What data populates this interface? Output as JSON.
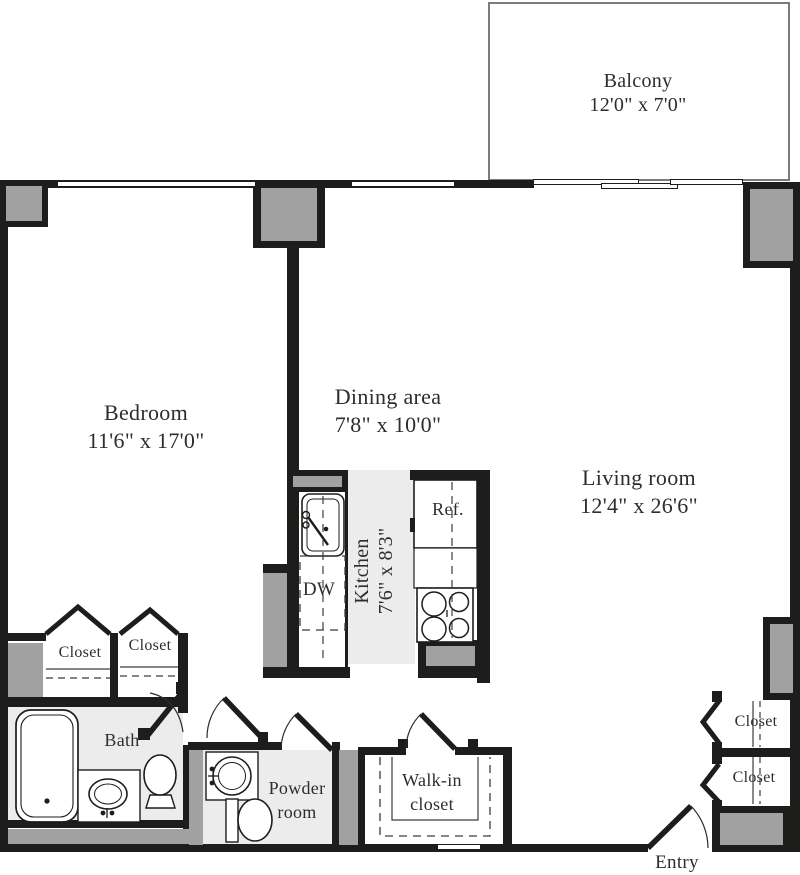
{
  "plan": {
    "balcony": {
      "name": "Balcony",
      "dims": "12'0\" x 7'0\""
    },
    "bedroom": {
      "name": "Bedroom",
      "dims": "11'6\" x 17'0\""
    },
    "dining": {
      "name": "Dining area",
      "dims": "7'8\" x 10'0\""
    },
    "living": {
      "name": "Living room",
      "dims": "12'4\" x 26'6\""
    },
    "kitchen": {
      "name": "Kitchen",
      "dims": "7'6\" x 8'3\""
    },
    "bath": {
      "name": "Bath"
    },
    "powder": {
      "line1": "Powder",
      "line2": "room"
    },
    "walkin": {
      "line1": "Walk-in",
      "line2": "closet"
    },
    "closet_bedroom_1": "Closet",
    "closet_bedroom_2": "Closet",
    "closet_hall_1": "Closet",
    "closet_hall_2": "Closet",
    "entry": "Entry",
    "dishwasher": "DW",
    "refrigerator": "Ref."
  },
  "colors": {
    "wall": "#1d1d1b",
    "column_fill": "#a1a1a1",
    "floor_tint": "#ececec",
    "balcony_line": "#7b7b7b",
    "text": "#2d2d2d"
  }
}
